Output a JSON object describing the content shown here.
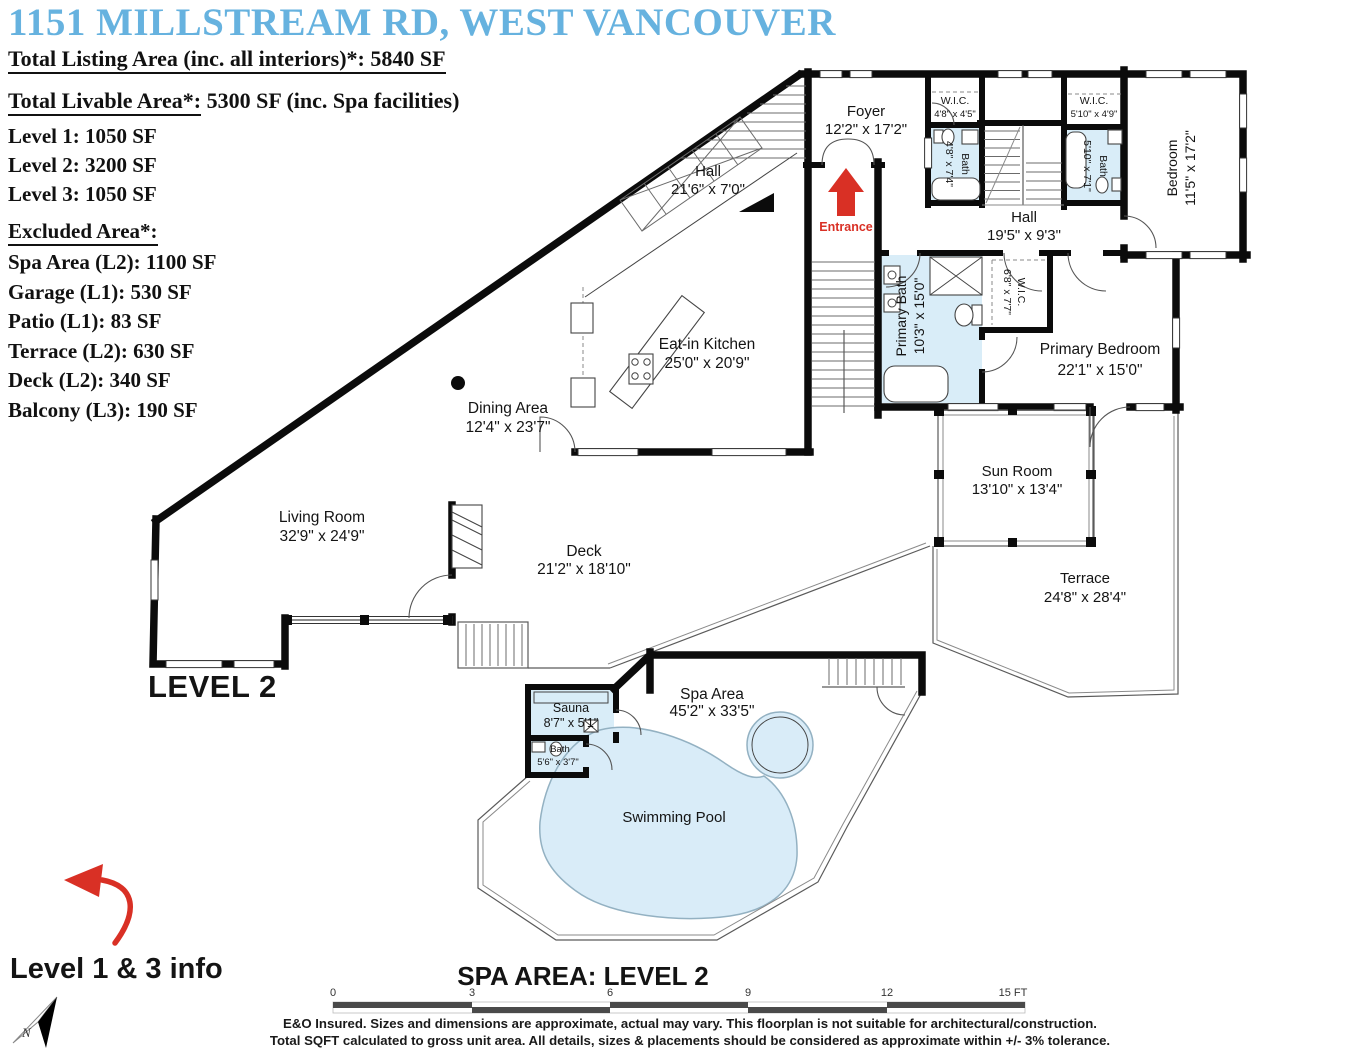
{
  "header": {
    "title": "1151 MILLSTREAM RD, WEST VANCOUVER",
    "listing_label": "Total Listing Area (inc. all interiors)*:",
    "listing_value": "5840 SF",
    "livable_label": "Total Livable Area*:",
    "livable_rest": " 5300 SF (inc. Spa facilities)",
    "levels": [
      "Level 1: 1050 SF",
      "Level 2: 3200 SF",
      "Level 3: 1050 SF"
    ],
    "excluded_title": "Excluded Area*:",
    "excluded": [
      "Spa Area (L2): 1100 SF",
      "Garage (L1): 530 SF",
      "Patio (L1): 83 SF",
      "Terrace (L2): 630 SF",
      "Deck (L2): 340 SF",
      "Balcony (L3): 190 SF"
    ]
  },
  "rooms": {
    "foyer": {
      "name": "Foyer",
      "dims": "12'2\" x 17'2\""
    },
    "hall_upper": {
      "name": "Hall",
      "dims": "21'6\" x 7'0\""
    },
    "wic_left": {
      "name": "W.I.C.",
      "dims": "4'8\" x 4'5\""
    },
    "bath_left": {
      "name": "Bath",
      "dims": "4'8\" x 7'4\""
    },
    "wic_right": {
      "name": "W.I.C.",
      "dims": "5'10\" x 4'9\""
    },
    "bath_right": {
      "name": "Bath",
      "dims": "5'10\" x 7'1\""
    },
    "bedroom": {
      "name": "Bedroom",
      "dims": "11'5\" x 17'2\""
    },
    "hall_lower": {
      "name": "Hall",
      "dims": "19'5\" x 9'3\""
    },
    "primary_bath": {
      "name": "Primary Bath",
      "dims": "10'3\" x 15'0\""
    },
    "wic_primary": {
      "name": "W.I.C.",
      "dims": "6'8\" x 7'7\""
    },
    "primary_bedroom": {
      "name": "Primary Bedroom",
      "dims": "22'1\" x 15'0\""
    },
    "eat_in_kitchen": {
      "name": "Eat-in Kitchen",
      "dims": "25'0\" x 20'9\""
    },
    "dining": {
      "name": "Dining Area",
      "dims": "12'4\" x 23'7\""
    },
    "living": {
      "name": "Living Room",
      "dims": "32'9\" x 24'9\""
    },
    "deck": {
      "name": "Deck",
      "dims": "21'2\" x 18'10\""
    },
    "sun_room": {
      "name": "Sun Room",
      "dims": "13'10\" x 13'4\""
    },
    "terrace": {
      "name": "Terrace",
      "dims": "24'8\" x 28'4\""
    },
    "spa": {
      "name": "Spa Area",
      "dims": "45'2\" x 33'5\""
    },
    "sauna": {
      "name": "Sauna",
      "dims": "8'7\" x 5'1\""
    },
    "bath_spa": {
      "name": "Bath",
      "dims": "5'6\" x 3'7\""
    },
    "pool": {
      "name": "Swimming Pool"
    }
  },
  "labels": {
    "entrance": "Entrance",
    "level2": "LEVEL 2",
    "spa_level": "SPA AREA: LEVEL 2",
    "level13_info": "Level 1 & 3 info",
    "north": "N"
  },
  "scale_bar": {
    "ticks": [
      "0",
      "3",
      "6",
      "9",
      "12",
      "15 FT"
    ]
  },
  "footer": {
    "line1": "E&O Insured. Sizes and dimensions are approximate, actual may vary. This floorplan is not suitable for architectural/construction.",
    "line2": "Total SQFT calculated to gross unit area. All details, sizes & placements should be considered as approximate within +/- 3% tolerance."
  },
  "colors": {
    "title_blue": "#66B2DF",
    "entrance_red": "#D93025",
    "room_blue": "#D9EDF8",
    "wall": "#0B0B0B"
  }
}
